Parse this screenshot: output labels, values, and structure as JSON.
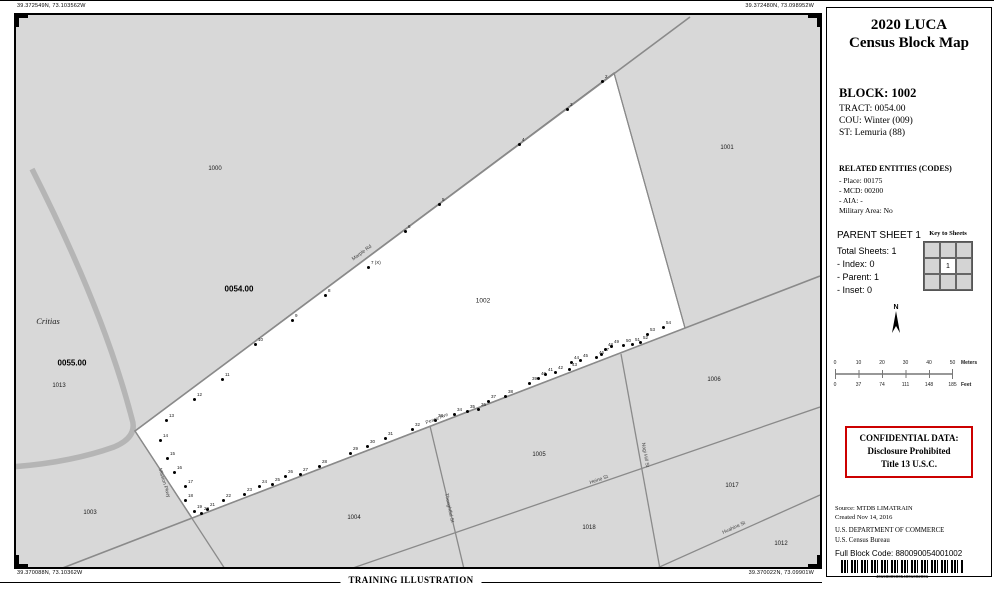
{
  "page": {
    "corner_coords": {
      "top_left": "39.372549N, 73.103562W",
      "top_right": "39.372480N, 73.098952W",
      "bottom_left": "39.370088N, 73.10362W",
      "bottom_right": "39.370022N, 73.09901W"
    },
    "footer_label": "TRAINING ILLUSTRATION"
  },
  "map": {
    "area_labels": [
      {
        "text": "1000",
        "x": 199,
        "y": 154,
        "cls": "block"
      },
      {
        "text": "1001",
        "x": 711,
        "y": 133,
        "cls": "block"
      },
      {
        "text": "0054.00",
        "x": 223,
        "y": 274,
        "cls": "tract"
      },
      {
        "text": "1002",
        "x": 467,
        "y": 286,
        "cls": "block main"
      },
      {
        "text": "Critias",
        "x": 32,
        "y": 306,
        "cls": "water"
      },
      {
        "text": "0055.00",
        "x": 56,
        "y": 348,
        "cls": "tract"
      },
      {
        "text": "1013",
        "x": 43,
        "y": 371,
        "cls": "block"
      },
      {
        "text": "1006",
        "x": 698,
        "y": 365,
        "cls": "block"
      },
      {
        "text": "1003",
        "x": 74,
        "y": 498,
        "cls": "block"
      },
      {
        "text": "1004",
        "x": 338,
        "y": 503,
        "cls": "block"
      },
      {
        "text": "1005",
        "x": 523,
        "y": 440,
        "cls": "block"
      },
      {
        "text": "1018",
        "x": 573,
        "y": 513,
        "cls": "block"
      },
      {
        "text": "1017",
        "x": 716,
        "y": 471,
        "cls": "block"
      },
      {
        "text": "1012",
        "x": 765,
        "y": 529,
        "cls": "block"
      }
    ],
    "road_labels": [
      {
        "text": "Marple Rd",
        "x": 346,
        "y": 238,
        "rot": -36
      },
      {
        "text": "Peace Ave",
        "x": 421,
        "y": 404,
        "rot": -21
      },
      {
        "text": "Mission Pkwy",
        "x": 148,
        "y": 468,
        "rot": 73
      },
      {
        "text": "Thoughtful St",
        "x": 433,
        "y": 493,
        "rot": 78
      },
      {
        "text": "Heine St",
        "x": 583,
        "y": 465,
        "rot": -19
      },
      {
        "text": "Nagi Hill St",
        "x": 629,
        "y": 440,
        "rot": 80
      },
      {
        "text": "Huahine St",
        "x": 718,
        "y": 513,
        "rot": -24
      }
    ],
    "map_spots": [
      {
        "n": "2",
        "x": 586,
        "y": 66
      },
      {
        "n": "3",
        "x": 551,
        "y": 94
      },
      {
        "n": "4",
        "x": 503,
        "y": 129
      },
      {
        "n": "5",
        "x": 423,
        "y": 189
      },
      {
        "n": "6",
        "x": 389,
        "y": 216
      },
      {
        "n": "7",
        "x": 352,
        "y": 252,
        "note": "(X)"
      },
      {
        "n": "8",
        "x": 309,
        "y": 280
      },
      {
        "n": "9",
        "x": 276,
        "y": 305
      },
      {
        "n": "10",
        "x": 239,
        "y": 329
      },
      {
        "n": "11",
        "x": 206,
        "y": 364
      },
      {
        "n": "12",
        "x": 178,
        "y": 384
      },
      {
        "n": "13",
        "x": 150,
        "y": 405
      },
      {
        "n": "14",
        "x": 144,
        "y": 425
      },
      {
        "n": "15",
        "x": 151,
        "y": 443
      },
      {
        "n": "16",
        "x": 158,
        "y": 457
      },
      {
        "n": "17",
        "x": 169,
        "y": 471
      },
      {
        "n": "18",
        "x": 169,
        "y": 485
      },
      {
        "n": "19",
        "x": 178,
        "y": 496
      },
      {
        "n": "20",
        "x": 185,
        "y": 498
      },
      {
        "n": "21",
        "x": 191,
        "y": 494
      },
      {
        "n": "22",
        "x": 207,
        "y": 485
      },
      {
        "n": "23",
        "x": 228,
        "y": 479
      },
      {
        "n": "24",
        "x": 243,
        "y": 471
      },
      {
        "n": "25",
        "x": 256,
        "y": 469
      },
      {
        "n": "26",
        "x": 269,
        "y": 461
      },
      {
        "n": "27",
        "x": 284,
        "y": 459
      },
      {
        "n": "28",
        "x": 303,
        "y": 451
      },
      {
        "n": "29",
        "x": 334,
        "y": 438
      },
      {
        "n": "30",
        "x": 351,
        "y": 431
      },
      {
        "n": "31",
        "x": 369,
        "y": 423
      },
      {
        "n": "32",
        "x": 396,
        "y": 414
      },
      {
        "n": "33",
        "x": 419,
        "y": 405
      },
      {
        "n": "34",
        "x": 438,
        "y": 399
      },
      {
        "n": "35",
        "x": 451,
        "y": 396
      },
      {
        "n": "36",
        "x": 462,
        "y": 394
      },
      {
        "n": "37",
        "x": 472,
        "y": 386
      },
      {
        "n": "38",
        "x": 489,
        "y": 381
      },
      {
        "n": "39",
        "x": 513,
        "y": 368
      },
      {
        "n": "40",
        "x": 522,
        "y": 363
      },
      {
        "n": "41",
        "x": 529,
        "y": 359
      },
      {
        "n": "42",
        "x": 539,
        "y": 357
      },
      {
        "n": "43",
        "x": 553,
        "y": 354
      },
      {
        "n": "44",
        "x": 555,
        "y": 347
      },
      {
        "n": "45",
        "x": 564,
        "y": 345
      },
      {
        "n": "46",
        "x": 580,
        "y": 342
      },
      {
        "n": "47",
        "x": 585,
        "y": 339
      },
      {
        "n": "48",
        "x": 589,
        "y": 334
      },
      {
        "n": "49",
        "x": 595,
        "y": 331
      },
      {
        "n": "50",
        "x": 607,
        "y": 330
      },
      {
        "n": "51",
        "x": 616,
        "y": 329
      },
      {
        "n": "52",
        "x": 624,
        "y": 327
      },
      {
        "n": "53",
        "x": 631,
        "y": 319
      },
      {
        "n": "54",
        "x": 647,
        "y": 312
      }
    ]
  },
  "sidebar": {
    "title_line1": "2020 LUCA",
    "title_line2": "Census Block Map",
    "block_heading": "BLOCK: 1002",
    "tract_line": "TRACT: 0054.00",
    "cou_line": "COU: Winter (009)",
    "st_line": "ST: Lemuria (88)",
    "related_heading": "RELATED ENTITIES (CODES)",
    "related_items": [
      "- Place: 00175",
      "- MCD: 00200",
      "- AIA:  -",
      "Military Area: No"
    ],
    "parent_sheet_heading": "PARENT SHEET 1",
    "sheet_lines": [
      "Total Sheets: 1",
      "- Index: 0",
      "- Parent: 1",
      "- Inset: 0"
    ],
    "key_to_sheets_label": "Key to Sheets",
    "key_center_cell": "1",
    "north_label": "N",
    "scale": {
      "meters_ticks": [
        "0",
        "10",
        "20",
        "30",
        "40",
        "50"
      ],
      "meters_unit": "Meters",
      "feet_ticks": [
        "0",
        "37",
        "74",
        "111",
        "148",
        "185"
      ],
      "feet_unit": "Feet"
    },
    "confidential_lines": [
      "CONFIDENTIAL DATA:",
      "Disclosure Prohibited",
      "Title 13 U.S.C."
    ],
    "source_lines": [
      "Source: MTDB LIMATRAIN",
      "Created Nov 14, 2016"
    ],
    "dept_lines": [
      "U.S. DEPARTMENT OF COMMERCE",
      "U.S. Census Bureau"
    ],
    "full_block_code": "Full Block Code: 880090054001002",
    "barcode_number": "401988090054001002001"
  },
  "colors": {
    "map_background": "#d8d8d8",
    "block_1002_fill": "#ffffff",
    "road": "#8a8a8a",
    "stream": "#b5b5b5",
    "confidential_border": "#cc0000"
  }
}
